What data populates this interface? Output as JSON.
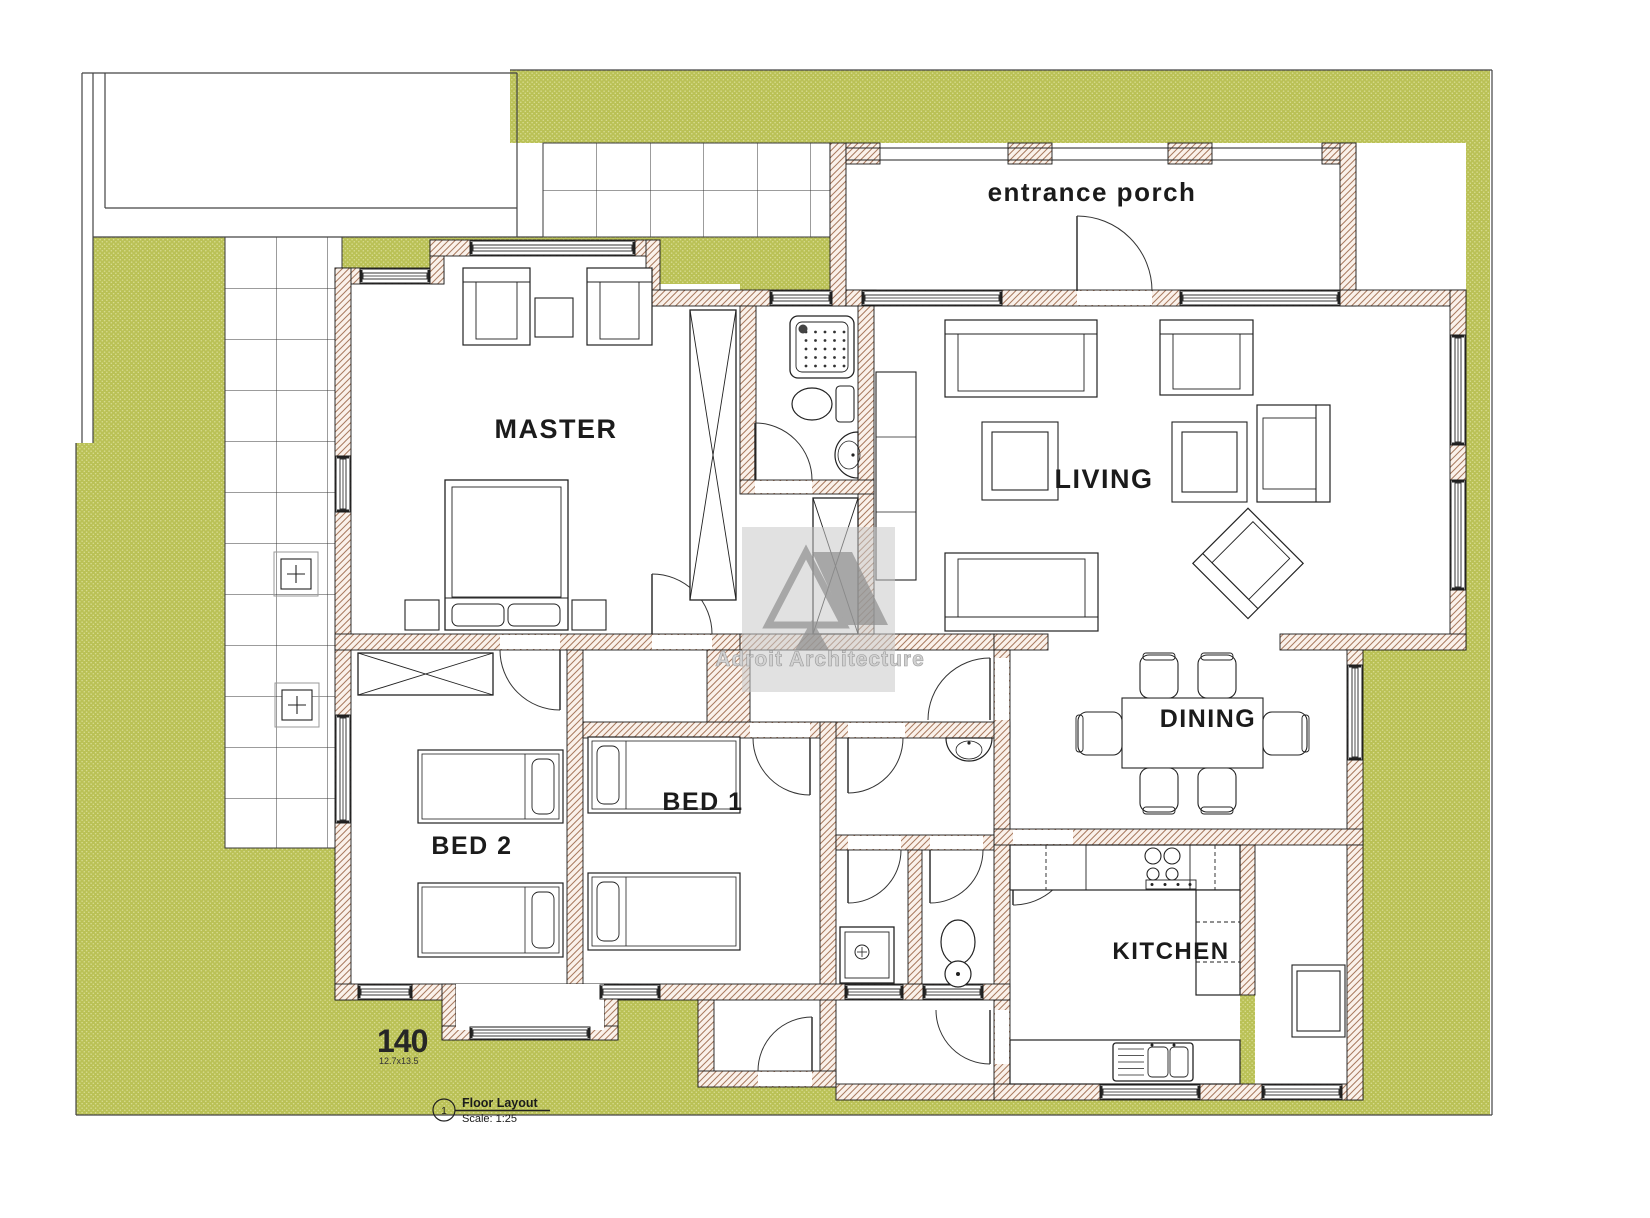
{
  "plan": {
    "rooms": {
      "porch": {
        "label": "entrance porch"
      },
      "master": {
        "label": "MASTER"
      },
      "living": {
        "label": "LIVING"
      },
      "dining": {
        "label": "DINING"
      },
      "bed1": {
        "label": "BED 1"
      },
      "bed2": {
        "label": "BED 2"
      },
      "kitchen": {
        "label": "KITCHEN"
      }
    },
    "area": {
      "number": "140",
      "dimensions": "12.7x13.5"
    },
    "titleblock": {
      "number": "1",
      "title": "Floor Layout",
      "scale": "Scale: 1:25"
    },
    "watermark": {
      "text": "Adroit Architecture"
    },
    "colors": {
      "grass": "#bac156",
      "grass_dot": "#d9dd93",
      "wall_hatch_line": "#a87a5f",
      "wall_hatch_bg": "#faf1ea",
      "line": "#1a1a1a",
      "watermark_gray": "#8f8f8f"
    }
  }
}
